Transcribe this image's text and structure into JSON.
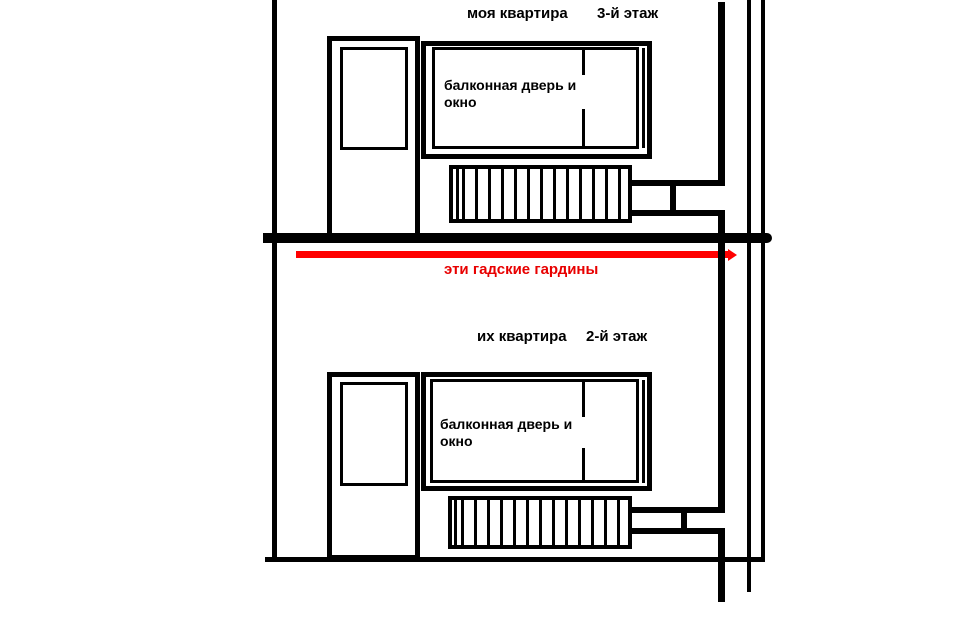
{
  "palette": {
    "background": "#ffffff",
    "ink": "#000000",
    "curtain_red": "#ff0000",
    "curtain_label_red": "#e80000"
  },
  "floor3": {
    "apartment_label": "моя квартира",
    "floor_label": "3-й этаж",
    "window_label_line1": "балконная дверь и",
    "window_label_line2": "окно"
  },
  "floor2": {
    "apartment_label": "их квартира",
    "floor_label": "2-й этаж",
    "window_label_line1": "балконная дверь и",
    "window_label_line2": "окно"
  },
  "curtains": {
    "label": "эти гадские гардины"
  }
}
